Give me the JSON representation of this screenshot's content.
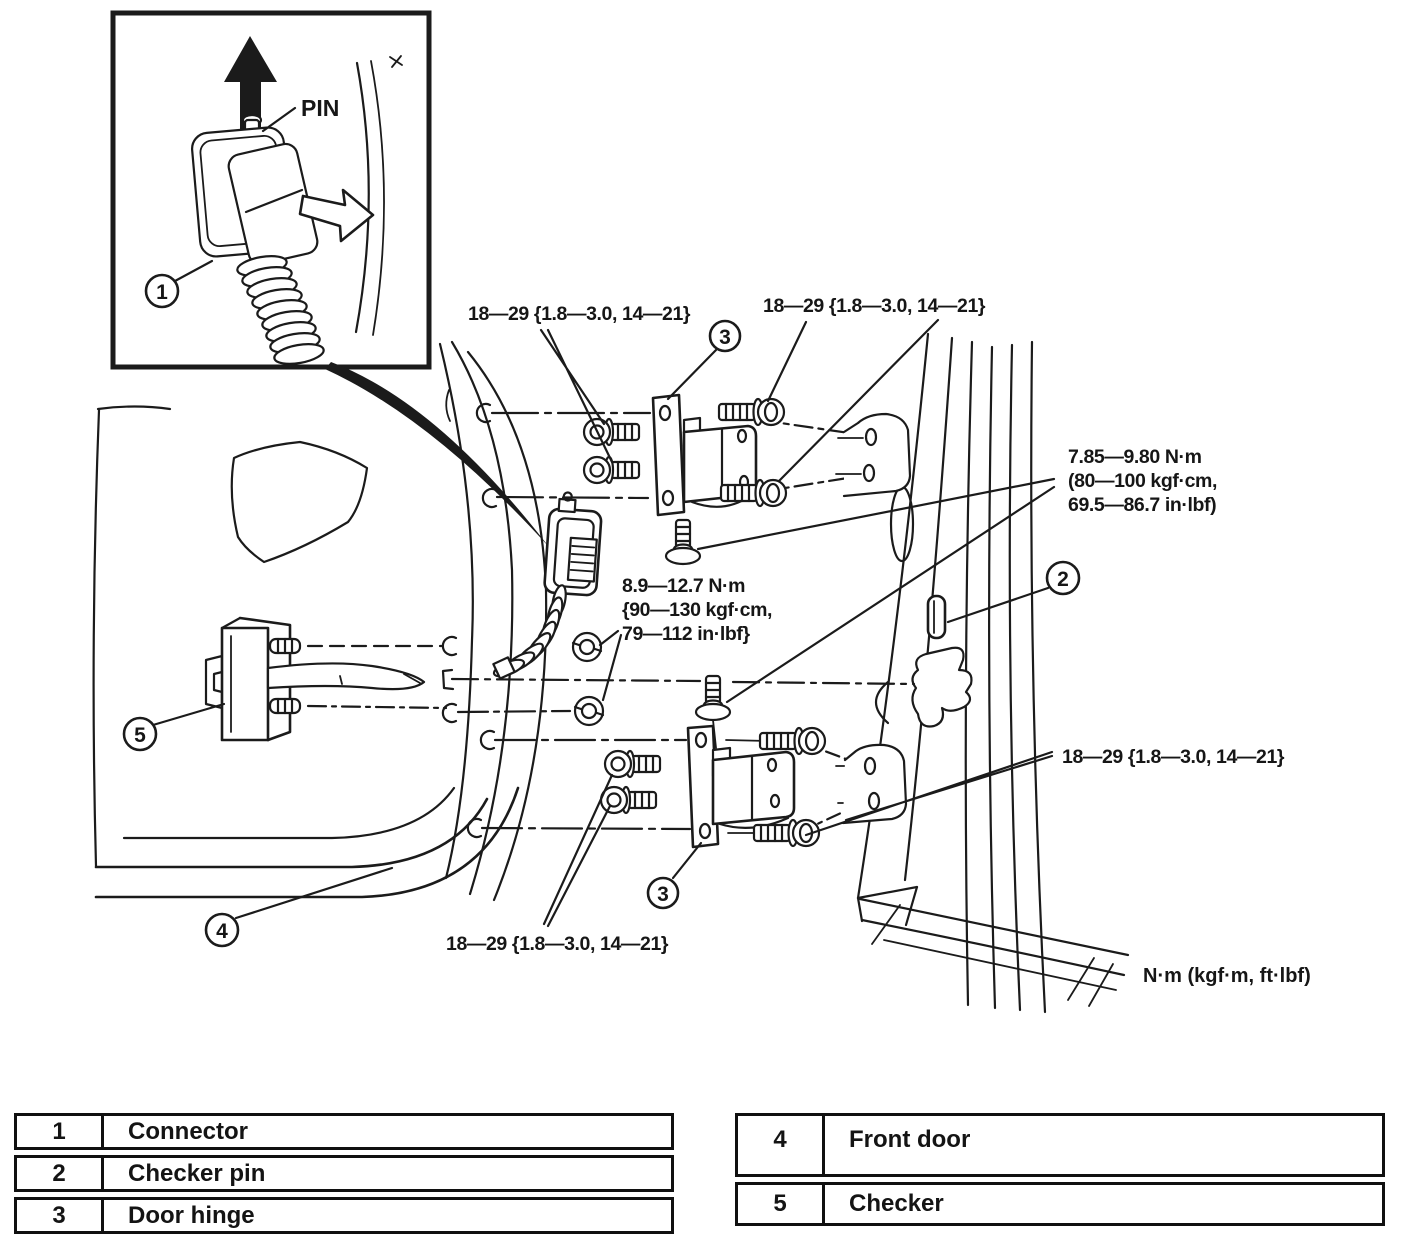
{
  "colors": {
    "ink": "#1b1b1b",
    "paper": "#ffffff"
  },
  "inset": {
    "pin_label": "PIN"
  },
  "callouts": {
    "n1": "1",
    "n2": "2",
    "n3": "3",
    "n4": "4",
    "n5": "5"
  },
  "torque": {
    "hinge_upper_left": "18—29 {1.8—3.0, 14—21}",
    "hinge_upper_right": "18—29 {1.8—3.0, 14—21}",
    "hinge_lower_left": "18—29 {1.8—3.0, 14—21}",
    "hinge_lower_right": "18—29 {1.8—3.0, 14—21}",
    "checker_bolt_l1": "7.85—9.80 N·m",
    "checker_bolt_l2": "(80—100 kgf·cm,",
    "checker_bolt_l3": "69.5—86.7 in·lbf)",
    "checker_nut_l1": "8.9—12.7 N·m",
    "checker_nut_l2": "{90—130 kgf·cm,",
    "checker_nut_l3": "79—112 in·lbf}",
    "units_note": "N·m (kgf·m, ft·lbf)"
  },
  "legend": {
    "left_table": [
      {
        "num": "1",
        "label": "Connector"
      },
      {
        "num": "2",
        "label": "Checker pin"
      },
      {
        "num": "3",
        "label": "Door hinge"
      }
    ],
    "right_table": [
      {
        "num": "4",
        "label": "Front door"
      },
      {
        "num": "5",
        "label": "Checker"
      }
    ]
  }
}
